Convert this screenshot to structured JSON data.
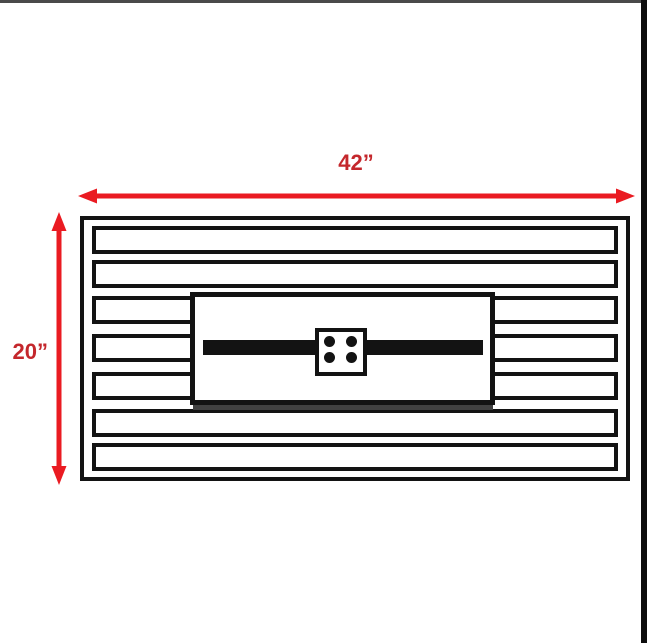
{
  "theme": {
    "background": "#ffffff",
    "line_black": "#131313",
    "arrow_red": "#ea1b22",
    "label_red": "#c4272c",
    "top_edge_gray": "#4a4a4a",
    "right_edge_black": "#0d0d0d",
    "shadow_gray": "#414141"
  },
  "drawing": {
    "dimensions": {
      "width_label": "42”",
      "height_label": "20”"
    },
    "slat_count": 7,
    "plate_bolt_count": 4
  }
}
